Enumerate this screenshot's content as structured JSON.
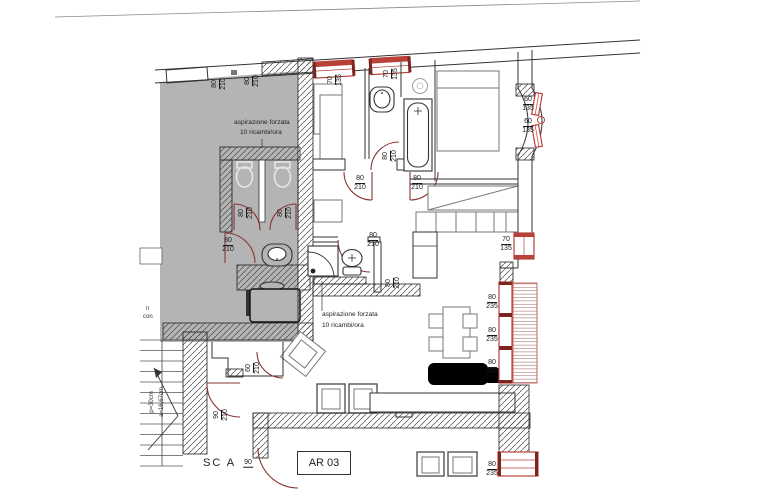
{
  "colors": {
    "door_red": "#8a3434",
    "window_red": "#b8423a",
    "window_dark": "#7e241f",
    "gray_fill": "#b4b4b4",
    "line": "#333333"
  },
  "annotations": {
    "vent_note_top": {
      "line1": "aspirazione forzata",
      "line2": "10 ricambi/ora"
    },
    "vent_note_bath2": {
      "line1": "aspirazione forzata",
      "line2": "10 ricambi/ora"
    },
    "stair_tread": "p=30cm",
    "stair_riser": "a=16,67cm",
    "edge_fragment_1": "n",
    "edge_fragment_2": "con",
    "stair_name": "SC A",
    "room_code": "AR 03"
  },
  "dimensions": [
    {
      "w": "80",
      "h": "210",
      "rot": true,
      "x": 219,
      "y": 84
    },
    {
      "w": "80",
      "h": "210",
      "rot": true,
      "x": 252,
      "y": 81
    },
    {
      "w": "70",
      "h": "135",
      "rot": true,
      "x": 335,
      "y": 80
    },
    {
      "w": "70",
      "h": "135",
      "rot": true,
      "x": 391,
      "y": 74
    },
    {
      "w": "80",
      "h": "210",
      "rot": true,
      "x": 246,
      "y": 213
    },
    {
      "w": "80",
      "h": "210",
      "rot": true,
      "x": 285,
      "y": 213
    },
    {
      "w": "80",
      "h": "210",
      "rot": false,
      "x": 228,
      "y": 245
    },
    {
      "w": "80",
      "h": "210",
      "rot": true,
      "x": 390,
      "y": 156
    },
    {
      "w": "80",
      "h": "210",
      "rot": false,
      "x": 360,
      "y": 183
    },
    {
      "w": "80",
      "h": "210",
      "rot": false,
      "x": 417,
      "y": 183
    },
    {
      "w": "60",
      "h": "135",
      "rot": false,
      "x": 528,
      "y": 104
    },
    {
      "w": "60",
      "h": "135",
      "rot": false,
      "x": 528,
      "y": 126
    },
    {
      "w": "70",
      "h": "135",
      "rot": false,
      "x": 506,
      "y": 244
    },
    {
      "w": "80",
      "h": "210",
      "rot": false,
      "x": 373,
      "y": 240
    },
    {
      "w": "80",
      "h": "210",
      "rot": true,
      "x": 393,
      "y": 283
    },
    {
      "w": "80",
      "h": "235",
      "rot": false,
      "x": 492,
      "y": 302
    },
    {
      "w": "80",
      "h": "235",
      "rot": false,
      "x": 492,
      "y": 335
    },
    {
      "w": "80",
      "h": "235",
      "rot": false,
      "x": 492,
      "y": 367
    },
    {
      "w": "80",
      "h": "235",
      "rot": false,
      "x": 492,
      "y": 469
    },
    {
      "w": "60",
      "h": "210",
      "rot": true,
      "x": 253,
      "y": 368
    },
    {
      "w": "90",
      "h": "210",
      "rot": true,
      "x": 221,
      "y": 415
    },
    {
      "w": "90",
      "h": "",
      "rot": false,
      "x": 248,
      "y": 463
    }
  ]
}
